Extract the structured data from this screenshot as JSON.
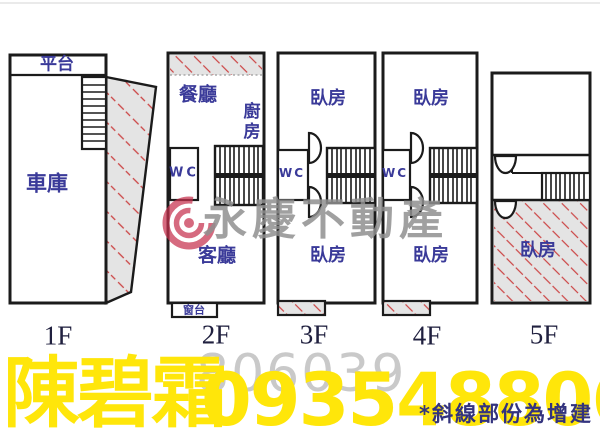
{
  "floors": {
    "f1": {
      "label": "1F",
      "platform": "平台",
      "garage": "車庫"
    },
    "f2": {
      "label": "2F",
      "dining": "餐廳",
      "kitchen": "廚房",
      "wc": "WC",
      "living": "客廳",
      "window_sill": "窗台"
    },
    "f3": {
      "label": "3F",
      "bedroom_top": "臥房",
      "wc": "WC",
      "bedroom_bottom": "臥房"
    },
    "f4": {
      "label": "4F",
      "bedroom_top": "臥房",
      "wc": "WC",
      "bedroom_bottom": "臥房"
    },
    "f5": {
      "label": "5F",
      "bedroom": "臥房"
    },
    "note": "*斜線部份為增建"
  },
  "watermark": {
    "brand": "永慶不動產",
    "code": "806039"
  },
  "contact": {
    "name": "陳碧霜",
    "phone": "0935488061"
  },
  "colors": {
    "wall": "#1b1b1b",
    "room_label": "#3a3a99",
    "floor_label": "#20203f",
    "hatch_bg": "#e4e4e4",
    "hatch_line": "#cc4444",
    "yellow": "#ffe60a",
    "watermark_gray": "#8f8f8f",
    "code_gray": "#c9c9c9",
    "note_navy": "#33337e",
    "logo_red": "#c63050"
  }
}
